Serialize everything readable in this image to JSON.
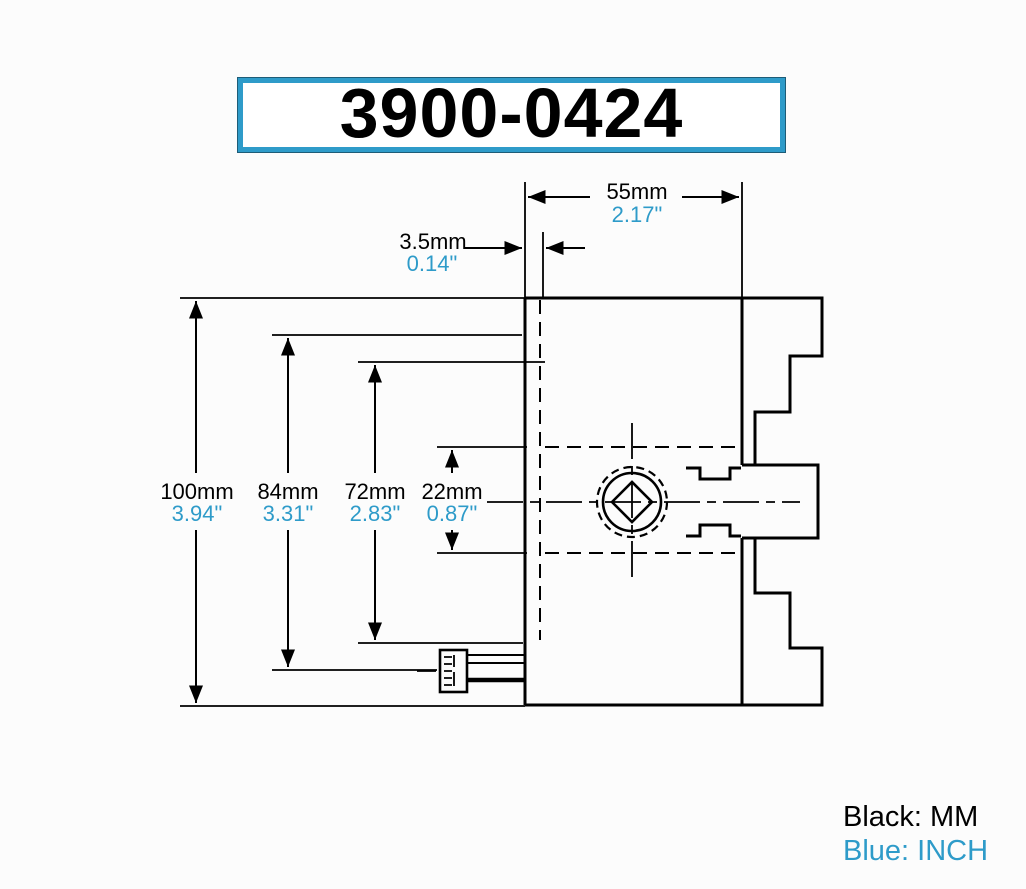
{
  "title": {
    "part_number": "3900-0424"
  },
  "legend": {
    "black_label": "Black: MM",
    "blue_label": "Blue: INCH"
  },
  "colors": {
    "blue_accent": "#2e9bc9",
    "line_black": "#000000",
    "background": "#fcfcfc"
  },
  "dimensions": {
    "body_width": {
      "mm": "55mm",
      "inch": "2.17\""
    },
    "backplate_thickness": {
      "mm": "3.5mm",
      "inch": "0.14\""
    },
    "overall_diameter": {
      "mm": "100mm",
      "inch": "3.94\""
    },
    "diameter_84": {
      "mm": "84mm",
      "inch": "3.31\""
    },
    "diameter_72": {
      "mm": "72mm",
      "inch": "2.83\""
    },
    "socket_offset": {
      "mm": "22mm",
      "inch": "0.87\""
    }
  }
}
